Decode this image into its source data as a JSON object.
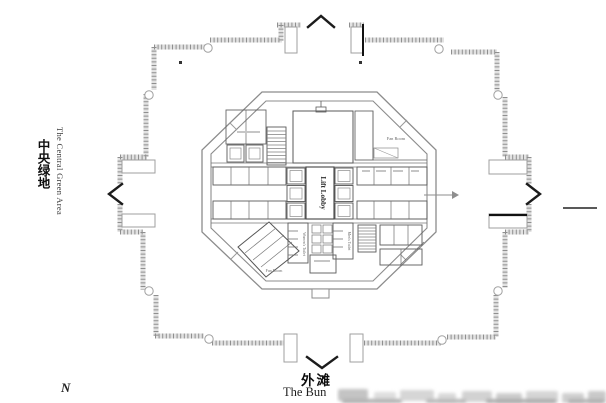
{
  "page": {
    "background": "#ffffff"
  },
  "labels": {
    "left_area_cn": "中央绿地",
    "left_area_en": "The Central Green Area",
    "bottom_area_cn": "外滩",
    "bottom_area_en": "The Bun",
    "north_mark": "N"
  },
  "plan": {
    "room_labels": {
      "lift_lobby": "Lift Lobby",
      "fan_room_top_right": "Fan Room",
      "fan_room_bottom_left": "Fan Room",
      "womens_toilet": "Women's Toilet",
      "mens_toilet": "Men's Toilet"
    },
    "colors": {
      "wall_gray": "#969696",
      "core_line": "#5a5a5a",
      "accent_black": "#1c1c1c",
      "watermark_gray": "#cccccc"
    }
  }
}
